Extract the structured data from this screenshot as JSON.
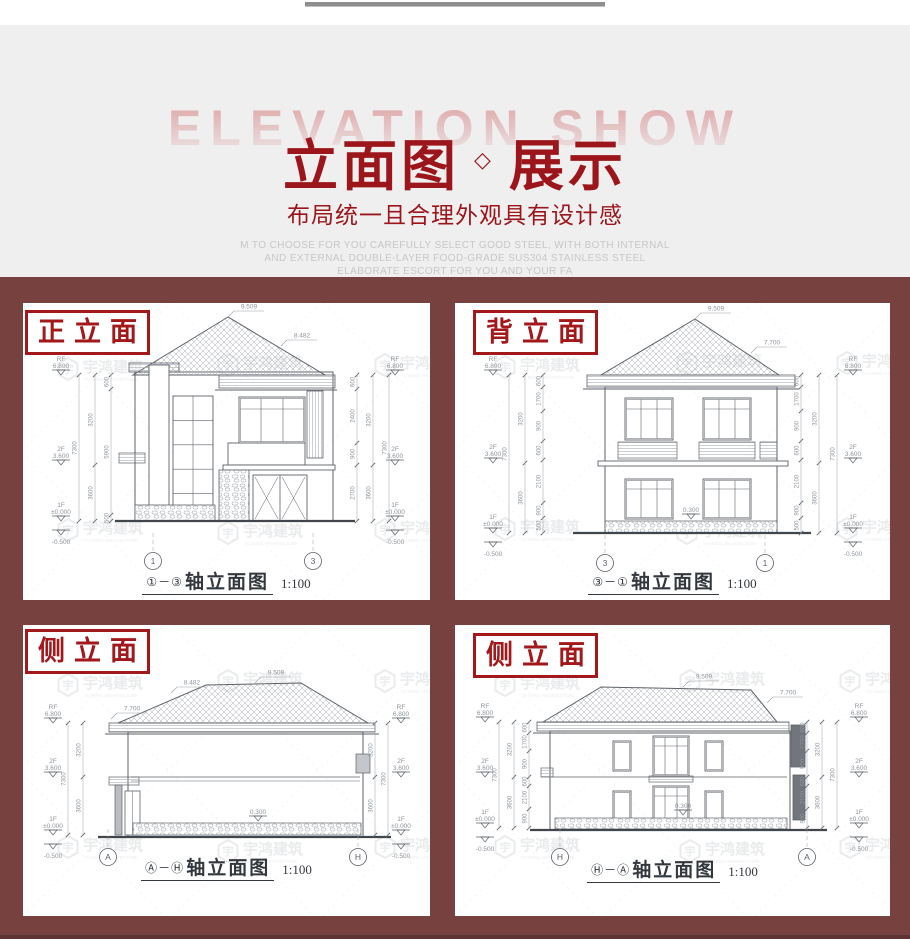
{
  "colors": {
    "page_bg": "#ffffff",
    "header_bg": "#efeff0",
    "maroon_bg": "#774140",
    "bottom_strip": "#5f3233",
    "title_red": "#9b151a",
    "tag_red": "#a2181b",
    "wm_pink": "#e0b0b0",
    "desc_gray": "#c7c7c7",
    "line": "#5d6269",
    "dim_text": "#8f959c",
    "dim_line": "#9aa0a7",
    "hatch": "#a9aeb4",
    "wm": "#d9dbde",
    "wm_line": "#e4e6e9",
    "ground": "#41464c"
  },
  "header": {
    "watermark_text": "ELEVATION SHOW",
    "title_part1": "立面图",
    "title_sep": "◇",
    "title_part2": "展示",
    "subtitle": "布局统一且合理外观具有设计感",
    "desc_lines": [
      "M TO CHOOSE FOR YOU CAREFULLY SELECT GOOD STEEL, WITH BOTH INTERNAL",
      "AND EXTERNAL DOUBLE-LAYER FOOD-GRADE SUS304 STAINLESS STEEL",
      "ELABORATE ESCORT FOR YOU AND YOUR FA"
    ]
  },
  "watermark": {
    "logo_char": "宇",
    "brand": "宇鸿建筑",
    "brand_sub": "YU HONG ARCHITECTURE"
  },
  "panels": [
    {
      "id": "front-elevation",
      "tag": "正立面",
      "caption_axes": "①－③",
      "caption_title": "轴立面图",
      "caption_scale": "1:100",
      "axis_left_char": "1",
      "axis_right_char": "3",
      "ridge_dim": "9.509",
      "roof_dims": [
        "8.482"
      ],
      "ground_dim": null,
      "levels": [
        [
          "RF",
          "6.800"
        ],
        [
          "2F",
          "3.600"
        ],
        [
          "1F",
          "±0.000"
        ],
        [
          "",
          "-0.500"
        ]
      ],
      "dim_chains_left": [
        [
          "600",
          "5900",
          "500"
        ],
        [
          "3200",
          "3600"
        ],
        [
          "7300"
        ]
      ],
      "dim_chains_right": [
        [
          "600",
          "2400",
          "900",
          "2700"
        ],
        [
          "3200",
          "3600"
        ],
        [
          "7300"
        ]
      ]
    },
    {
      "id": "back-elevation",
      "tag": "背立面",
      "caption_axes": "③－①",
      "caption_title": "轴立面图",
      "caption_scale": "1:100",
      "axis_left_char": "3",
      "axis_right_char": "1",
      "ridge_dim": "9.509",
      "roof_dims": [
        "7.700"
      ],
      "ground_dim": "0.300",
      "levels": [
        [
          "RF",
          "6.800"
        ],
        [
          "2F",
          "3.600"
        ],
        [
          "1F",
          "±0.000"
        ],
        [
          "",
          "-0.500"
        ]
      ],
      "dim_chains_left": [
        [
          "600",
          "1700",
          "900",
          "600",
          "2100",
          "900",
          "500"
        ],
        [
          "3200",
          "3600"
        ],
        [
          "7300"
        ]
      ],
      "dim_chains_right": [
        [
          "600",
          "1700",
          "900",
          "600",
          "2100",
          "900",
          "500"
        ],
        [
          "3200",
          "3600"
        ],
        [
          "7300"
        ]
      ]
    },
    {
      "id": "side-elevation-a",
      "tag": "侧立面",
      "caption_axes": "Ⓐ－Ⓗ",
      "caption_title": "轴立面图",
      "caption_scale": "1:100",
      "axis_left_char": "A",
      "axis_right_char": "H",
      "ridge_dim": "9.509",
      "roof_dims": [
        "8.482",
        "7.700"
      ],
      "ground_dim": "0.300",
      "levels": [
        [
          "RF",
          "6.800"
        ],
        [
          "2F",
          "3.600"
        ],
        [
          "1F",
          "±0.000"
        ],
        [
          "",
          "-0.500"
        ]
      ],
      "dim_chains_left": [
        [
          "3200",
          "3600"
        ],
        [
          "7300"
        ]
      ],
      "dim_chains_right": [
        [
          "3200",
          "3600"
        ],
        [
          "7300"
        ]
      ]
    },
    {
      "id": "side-elevation-h",
      "tag": "侧立面",
      "caption_axes": "Ⓗ－Ⓐ",
      "caption_title": "轴立面图",
      "caption_scale": "1:100",
      "axis_left_char": "H",
      "axis_right_char": "A",
      "ridge_dim": "9.509",
      "roof_dims": [
        "7.700"
      ],
      "ground_dim": "0.300",
      "levels": [
        [
          "RF",
          "6.800"
        ],
        [
          "2F",
          "3.600"
        ],
        [
          "1F",
          "±0.000"
        ],
        [
          "",
          "-0.500"
        ]
      ],
      "dim_chains_left": [
        [
          "600",
          "1700",
          "900",
          "600",
          "2100",
          "900"
        ],
        [
          "3200",
          "3600"
        ],
        [
          "7300"
        ]
      ],
      "dim_chains_right": [
        [
          "600",
          "1700",
          "900",
          "600",
          "2100",
          "900"
        ],
        [
          "3200",
          "3600"
        ],
        [
          "7300"
        ]
      ]
    }
  ]
}
